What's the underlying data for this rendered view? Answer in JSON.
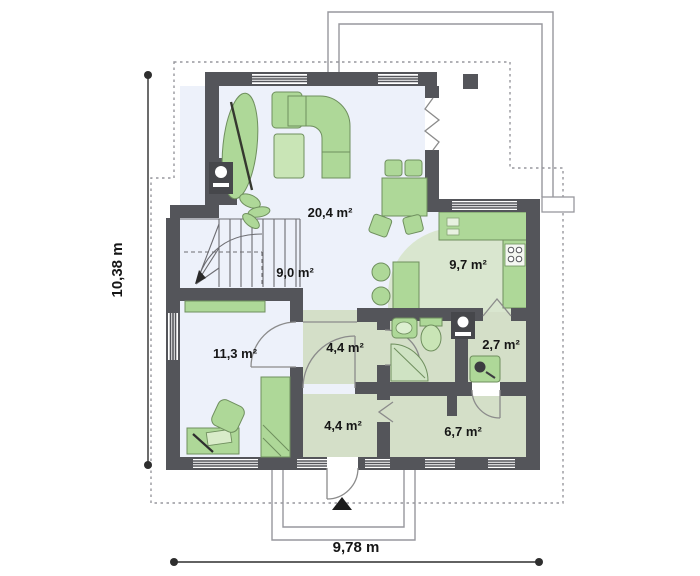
{
  "colors": {
    "wall": "#54555a",
    "floor_main": "#edf1fa",
    "floor_sage": "#d4dfc8",
    "floor_kitchen": "#d9e6cf",
    "furniture": "#aed898",
    "furniture_light": "#c9e5b6",
    "furniture_stroke": "#6f8f5e",
    "appliance_dark": "#46474b",
    "thin_line": "#97979d",
    "door_line": "#8b8b8b",
    "dim_line": "#2e2e2e",
    "text_color": "#161616"
  },
  "rooms": {
    "living": {
      "label": "20,4 m²"
    },
    "hall": {
      "label": "9,0 m²"
    },
    "kitchen": {
      "label": "9,7 m²"
    },
    "bedroom": {
      "label": "11,3 m²"
    },
    "corridor": {
      "label": "4,4 m²"
    },
    "tech": {
      "label": "2,7 m²"
    },
    "vestibule": {
      "label": "4,4 m²"
    },
    "utility": {
      "label": "6,7 m²"
    }
  },
  "dimensions": {
    "width": "9,78 m",
    "height": "10,38 m"
  }
}
